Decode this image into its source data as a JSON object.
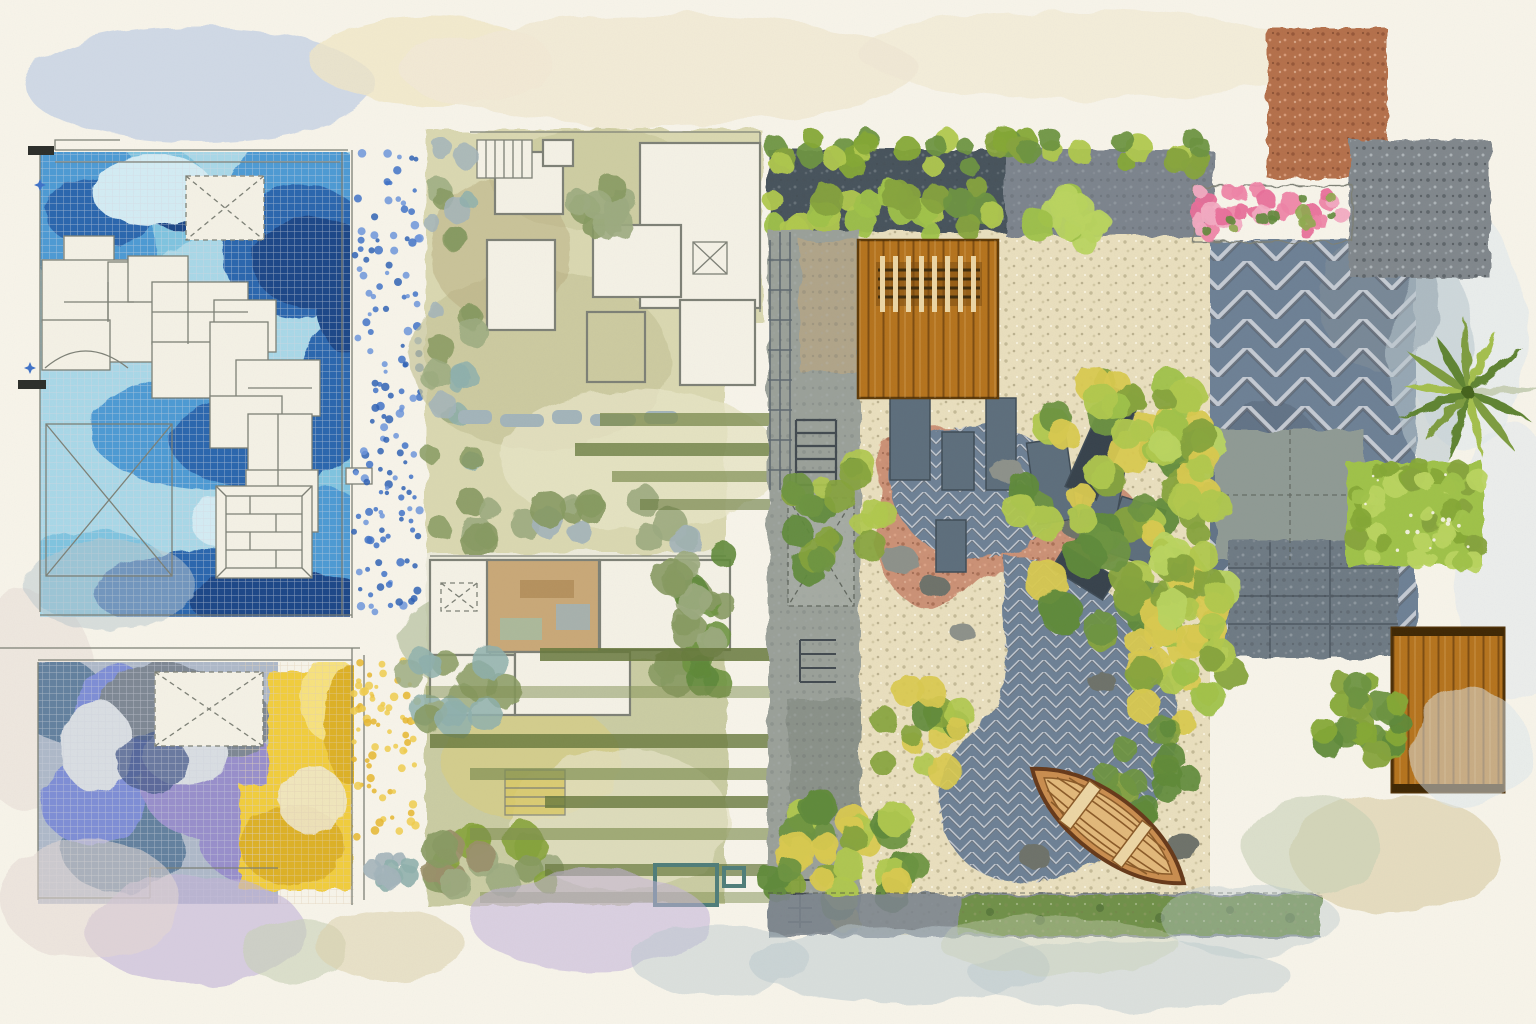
{
  "artwork": {
    "kind": "watercolor-landscape-plan-collage",
    "regions": [
      {
        "id": "pool-terrace-plan",
        "label": "blue mosaic pool terrace plan"
      },
      {
        "id": "purple-yellow-terrace-plan",
        "label": "purple and yellow mosaic terrace plan"
      },
      {
        "id": "courtyard-plan-top",
        "label": "olive-green courtyard floor plan"
      },
      {
        "id": "courtyard-plan-bottom",
        "label": "green courtyard floor plan with pergola beams"
      },
      {
        "id": "zen-garden-plan",
        "label": "large garden plan with deck, gravel, winding stone path and boat"
      },
      {
        "id": "material-swatches",
        "label": "paving material swatches: terracotta, aggregate, herringbone"
      },
      {
        "id": "palm-tree",
        "label": "palm tree top view"
      },
      {
        "id": "bougainvillea-planter",
        "label": "pink flowering planter band"
      },
      {
        "id": "wood-decks",
        "label": "timber deck rectangles"
      },
      {
        "id": "edge-washes",
        "label": "loose watercolor border washes"
      }
    ]
  },
  "palette": {
    "paper": "#f7f4ea",
    "creamBand": "#f0e7d0",
    "ink": "#7d8076",
    "inkDark": "#4a4f46",
    "poolBase": "#a9d8e8",
    "poolCyan": "#7fc4e0",
    "poolMid": "#4e9ad4",
    "poolDeep": "#2b66ae",
    "poolNavy": "#1b4688",
    "poolPale": "#d3ecf4",
    "dotBlue": "#3f72c8",
    "dotBlue2": "#6d95dc",
    "dotBlue3": "#2f62b5",
    "purBase": "#aeb9c9",
    "purSteel": "#64819f",
    "purPeri": "#7e8ed6",
    "purLav": "#988fcb",
    "purSlate": "#7e8894",
    "purPale": "#d9dee3",
    "purDeep": "#4e5f8e",
    "yelBase": "#f1cd3c",
    "yelDeep": "#ddb126",
    "yelPale": "#f7e27e",
    "dotYellow": "#e6b62e",
    "dotYellow2": "#f0cc4e",
    "oliveBase": "#d6d5ab",
    "oliveLight": "#e6e3c4",
    "khaki": "#c6c498",
    "bar": "#7f8f52",
    "barDark": "#66783c",
    "roomWhite": "#f4f1e6",
    "tanRoom": "#c9a878",
    "poolTeal": "#bcd8c0",
    "sage": "#9cab80",
    "oliveTree": "#879a62",
    "teal": "#8fb0ad",
    "grayGreen": "#a3b4ba",
    "brownTree": "#9a8f6a",
    "charHedge": "#46525c",
    "stoneGray": "#7b848d",
    "wallGray": "#9aa099",
    "slabGray": "#8f9a94",
    "gravelCream": "#e9dfbe",
    "gravelPink": "#c98a70",
    "herrBase": "#6d8095",
    "deckWood": "#b5731d",
    "deckWoodD": "#8a5512",
    "postLight": "#ecd6a4",
    "slatDark": "#3f2c0c",
    "slatePill": "#5d6e7c",
    "shr1": "#86a33c",
    "shr2": "#b0c84e",
    "shr3": "#5f8a3a",
    "shr4": "#d9c94f",
    "shr5": "#6d9440",
    "hedge1": "#9fc24a",
    "hedge2": "#b9d45f",
    "hedge3": "#85a836",
    "rock": "#8d918a",
    "rockD": "#6e726a",
    "boatHull": "#c98d4f",
    "boatRim": "#e2b87a",
    "boatLine": "#8a5a28",
    "boatDark": "#66391a",
    "terr": "#b4704c",
    "terrD": "#8a4f34",
    "terrL": "#d89a78",
    "agg": "#80878c",
    "aggD": "#565c60",
    "aggL": "#b2b8bc",
    "pink1": "#ee85a8",
    "pink2": "#e86f9a",
    "pink3": "#f2aac2",
    "pinkLeaf": "#8faa50",
    "grass": "#6f9048",
    "grassD": "#55743a",
    "palm1": "#7d9c3f",
    "palm2": "#5f8433",
    "palm3": "#a4bf4e",
    "washBlue": "#b9c9e4",
    "washYel": "#eee3c0",
    "washLav": "#c2b3d9",
    "washSage": "#c8d0b6",
    "washTan": "#ddd2ac",
    "washPinkG": "#e5d8d3",
    "washSteel": "#b9c7ce",
    "washPale": "#dce6ec"
  }
}
